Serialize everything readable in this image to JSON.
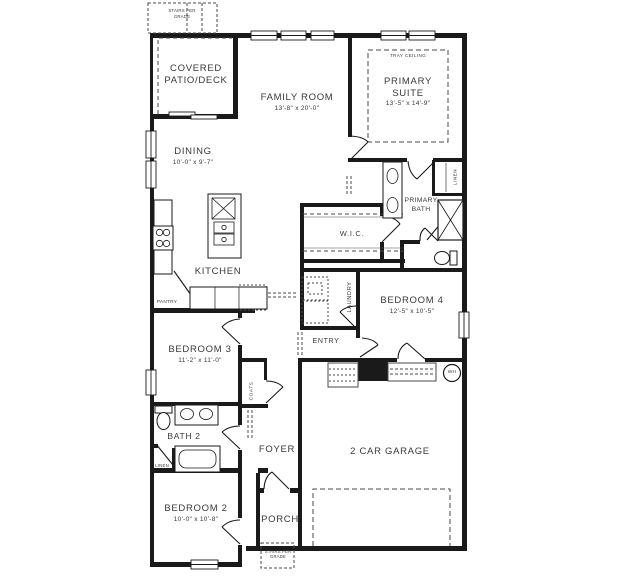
{
  "rooms": {
    "covered_patio": {
      "name": "COVERED\nPATIO/DECK"
    },
    "family_room": {
      "name": "FAMILY ROOM",
      "dims": "13'-8\" x 20'-0\""
    },
    "primary_suite": {
      "name": "PRIMARY\nSUITE",
      "dims": "13'-5\" x 14'-9\"",
      "ceiling": "TRAY CEILING"
    },
    "dining": {
      "name": "DINING",
      "dims": "10'-0\" x 9'-7\""
    },
    "kitchen": {
      "name": "KITCHEN"
    },
    "pantry": {
      "name": "PANTRY"
    },
    "wic": {
      "name": "W.I.C."
    },
    "primary_bath": {
      "name": "PRIMARY\nBATH"
    },
    "linen_primary": {
      "name": "LINEN"
    },
    "laundry": {
      "name": "LAUNDRY"
    },
    "bedroom4": {
      "name": "BEDROOM 4",
      "dims": "12'-5\" x 10'-5\""
    },
    "entry": {
      "name": "ENTRY"
    },
    "bedroom3": {
      "name": "BEDROOM 3",
      "dims": "11'-2\" x 11'-0\""
    },
    "coats": {
      "name": "COATS"
    },
    "bath2": {
      "name": "BATH 2"
    },
    "linen_hall": {
      "name": "LINEN"
    },
    "foyer": {
      "name": "FOYER"
    },
    "bedroom2": {
      "name": "BEDROOM 2",
      "dims": "10'-0\" x 10'-8\""
    },
    "porch": {
      "name": "PORCH"
    },
    "garage": {
      "name": "2 CAR GARAGE"
    }
  },
  "annotations": {
    "stairs_top": "STAIRS PER\nGRADE",
    "stairs_bottom": "STAIRS PER\nGRADE",
    "water_heater": "WH"
  },
  "colors": {
    "wall": "#1a1a1a",
    "text": "#3a3a3a",
    "background": "#ffffff"
  }
}
